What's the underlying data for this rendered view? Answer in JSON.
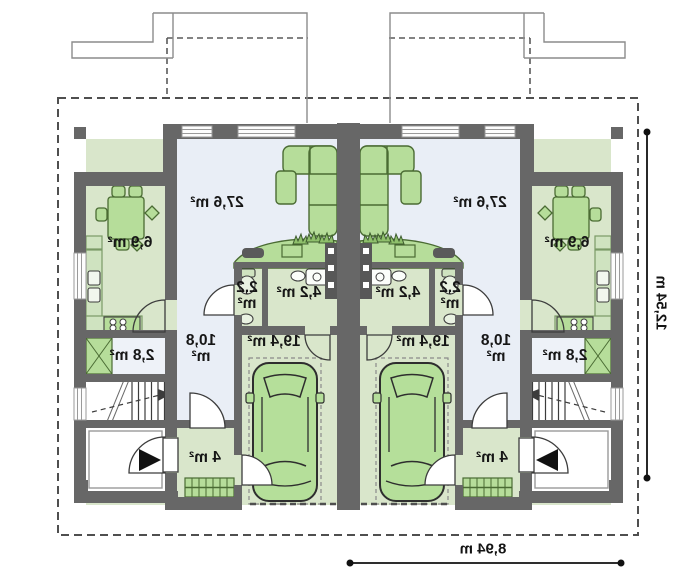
{
  "plan": {
    "title": "duplex-ground-floor-plan-mirrored",
    "rooms": {
      "living": "27,6 m²",
      "kitchen": "6,9 m²",
      "pantry": "2,8 m²",
      "hall": "10,8 m²",
      "wc": "2,2 m²",
      "bath": "4,2 m²",
      "garage": "19,4 m²",
      "entry": "4 m²"
    },
    "dimensions": {
      "unit_width": "8,94 m",
      "house_depth": "12,54 m"
    },
    "colors": {
      "wall": "#676767",
      "room_green": "#d9e6cb",
      "room_blue": "#e9eef6",
      "furniture_green": "#b6dd9a",
      "car_green": "#b5df9a"
    }
  }
}
